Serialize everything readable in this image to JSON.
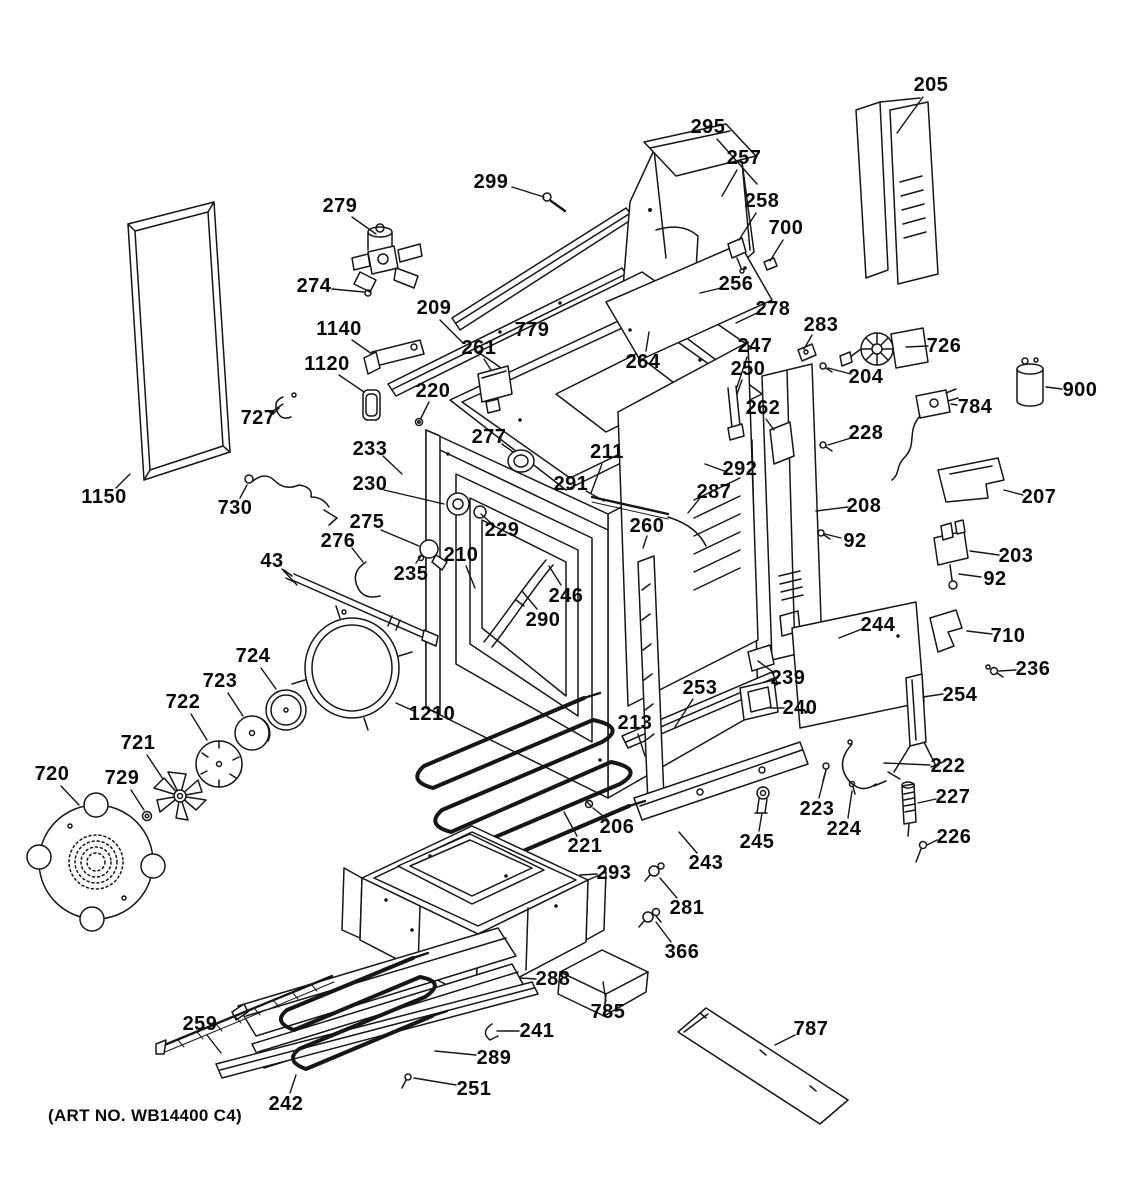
{
  "meta": {
    "art_no": "(ART NO. WB14400 C4)",
    "line_color": "#161616",
    "background_color": "#ffffff"
  },
  "callouts": [
    {
      "label": "205",
      "x": 931,
      "y": 85,
      "leader": [
        923,
        97,
        897,
        133
      ]
    },
    {
      "label": "295",
      "x": 708,
      "y": 127,
      "leader": [
        717,
        139,
        757,
        184
      ]
    },
    {
      "label": "257",
      "x": 744,
      "y": 158,
      "leader": [
        737,
        170,
        722,
        196
      ]
    },
    {
      "label": "299",
      "x": 491,
      "y": 182,
      "leader": [
        512,
        187,
        544,
        197
      ]
    },
    {
      "label": "258",
      "x": 762,
      "y": 201,
      "leader": [
        756,
        213,
        739,
        240
      ]
    },
    {
      "label": "700",
      "x": 786,
      "y": 228,
      "leader": [
        783,
        240,
        770,
        261
      ]
    },
    {
      "label": "279",
      "x": 340,
      "y": 206,
      "leader": [
        352,
        217,
        376,
        234
      ]
    },
    {
      "label": "274",
      "x": 314,
      "y": 286,
      "leader": [
        332,
        289,
        364,
        292
      ]
    },
    {
      "label": "256",
      "x": 736,
      "y": 284,
      "leader": [
        721,
        288,
        700,
        293
      ]
    },
    {
      "label": "278",
      "x": 773,
      "y": 309,
      "leader": [
        757,
        313,
        736,
        323
      ]
    },
    {
      "label": "283",
      "x": 821,
      "y": 325,
      "leader": [
        812,
        335,
        804,
        349
      ]
    },
    {
      "label": "726",
      "x": 944,
      "y": 346,
      "leader": [
        928,
        346,
        906,
        347
      ]
    },
    {
      "label": "209",
      "x": 434,
      "y": 308,
      "leader": [
        440,
        320,
        463,
        343
      ]
    },
    {
      "label": "1140",
      "x": 339,
      "y": 329,
      "leader": [
        352,
        340,
        372,
        354
      ]
    },
    {
      "label": "779",
      "x": 532,
      "y": 330,
      "leader": null
    },
    {
      "label": "261",
      "x": 479,
      "y": 348,
      "leader": [
        484,
        359,
        491,
        370
      ]
    },
    {
      "label": "1120",
      "x": 327,
      "y": 364,
      "leader": [
        339,
        375,
        364,
        392
      ]
    },
    {
      "label": "264",
      "x": 643,
      "y": 362,
      "leader": [
        646,
        351,
        649,
        332
      ]
    },
    {
      "label": "247",
      "x": 755,
      "y": 346,
      "leader": [
        747,
        357,
        737,
        387
      ]
    },
    {
      "label": "250",
      "x": 748,
      "y": 369,
      "leader": [
        742,
        380,
        737,
        394
      ]
    },
    {
      "label": "204",
      "x": 866,
      "y": 377,
      "leader": [
        851,
        374,
        828,
        368
      ]
    },
    {
      "label": "262",
      "x": 763,
      "y": 408,
      "leader": [
        766,
        419,
        774,
        430
      ]
    },
    {
      "label": "900",
      "x": 1080,
      "y": 390,
      "leader": [
        1062,
        389,
        1046,
        387
      ]
    },
    {
      "label": "784",
      "x": 975,
      "y": 407,
      "leader": [
        957,
        405,
        951,
        404
      ]
    },
    {
      "label": "220",
      "x": 433,
      "y": 391,
      "leader": [
        429,
        402,
        421,
        418
      ]
    },
    {
      "label": "727",
      "x": 258,
      "y": 418,
      "leader": [
        270,
        413,
        283,
        404
      ]
    },
    {
      "label": "277",
      "x": 489,
      "y": 437,
      "leader": [
        502,
        444,
        513,
        452
      ]
    },
    {
      "label": "211",
      "x": 607,
      "y": 452,
      "leader": [
        602,
        464,
        591,
        493
      ]
    },
    {
      "label": "291",
      "x": 571,
      "y": 484,
      "leader": [
        586,
        491,
        604,
        501
      ]
    },
    {
      "label": "292",
      "x": 740,
      "y": 469,
      "leader": [
        727,
        472,
        705,
        464
      ]
    },
    {
      "label": "287",
      "x": 714,
      "y": 492,
      "leader": [
        700,
        498,
        688,
        513
      ]
    },
    {
      "label": "228",
      "x": 866,
      "y": 433,
      "leader": [
        851,
        438,
        828,
        445
      ]
    },
    {
      "label": "233",
      "x": 370,
      "y": 449,
      "leader": [
        383,
        456,
        402,
        474
      ]
    },
    {
      "label": "230",
      "x": 370,
      "y": 484,
      "leader": [
        384,
        490,
        444,
        504
      ]
    },
    {
      "label": "229",
      "x": 502,
      "y": 530,
      "leader": [
        491,
        523,
        481,
        514
      ]
    },
    {
      "label": "260",
      "x": 647,
      "y": 526,
      "leader": [
        647,
        536,
        643,
        548
      ]
    },
    {
      "label": "208",
      "x": 864,
      "y": 506,
      "leader": [
        848,
        507,
        816,
        511
      ]
    },
    {
      "label": "92",
      "x": 855,
      "y": 541,
      "leader": [
        841,
        538,
        825,
        534
      ]
    },
    {
      "label": "207",
      "x": 1039,
      "y": 497,
      "leader": [
        1023,
        495,
        1004,
        490
      ]
    },
    {
      "label": "203",
      "x": 1016,
      "y": 556,
      "leader": [
        999,
        555,
        970,
        551
      ]
    },
    {
      "label": "92",
      "x": 995,
      "y": 579,
      "leader": [
        981,
        577,
        959,
        574
      ]
    },
    {
      "label": "275",
      "x": 367,
      "y": 522,
      "leader": [
        381,
        530,
        419,
        546
      ]
    },
    {
      "label": "276",
      "x": 338,
      "y": 541,
      "leader": [
        352,
        548,
        363,
        562
      ]
    },
    {
      "label": "43",
      "x": 272,
      "y": 561,
      "leader": [
        282,
        569,
        297,
        585
      ]
    },
    {
      "label": "730",
      "x": 235,
      "y": 508,
      "leader": [
        240,
        498,
        247,
        485
      ]
    },
    {
      "label": "1150",
      "x": 104,
      "y": 497,
      "leader": [
        116,
        488,
        130,
        474
      ]
    },
    {
      "label": "235",
      "x": 411,
      "y": 574,
      "leader": [
        416,
        563,
        421,
        556
      ]
    },
    {
      "label": "210",
      "x": 461,
      "y": 555,
      "leader": [
        466,
        566,
        475,
        588
      ]
    },
    {
      "label": "246",
      "x": 566,
      "y": 596,
      "leader": [
        561,
        585,
        549,
        566
      ]
    },
    {
      "label": "290",
      "x": 543,
      "y": 620,
      "leader": [
        537,
        609,
        522,
        591
      ]
    },
    {
      "label": "244",
      "x": 878,
      "y": 625,
      "leader": [
        862,
        629,
        839,
        638
      ]
    },
    {
      "label": "710",
      "x": 1008,
      "y": 636,
      "leader": [
        992,
        634,
        967,
        631
      ]
    },
    {
      "label": "236",
      "x": 1033,
      "y": 669,
      "leader": [
        1016,
        670,
        999,
        671
      ]
    },
    {
      "label": "254",
      "x": 960,
      "y": 695,
      "leader": [
        943,
        694,
        923,
        697
      ]
    },
    {
      "label": "724",
      "x": 253,
      "y": 656,
      "leader": [
        261,
        668,
        276,
        689
      ]
    },
    {
      "label": "723",
      "x": 220,
      "y": 681,
      "leader": [
        228,
        693,
        243,
        716
      ]
    },
    {
      "label": "722",
      "x": 183,
      "y": 702,
      "leader": [
        191,
        714,
        207,
        740
      ]
    },
    {
      "label": "721",
      "x": 138,
      "y": 743,
      "leader": [
        147,
        755,
        163,
        779
      ]
    },
    {
      "label": "729",
      "x": 122,
      "y": 778,
      "leader": [
        131,
        790,
        144,
        810
      ]
    },
    {
      "label": "720",
      "x": 52,
      "y": 774,
      "leader": [
        61,
        786,
        79,
        805
      ]
    },
    {
      "label": "1210",
      "x": 432,
      "y": 714,
      "leader": [
        414,
        711,
        396,
        703
      ]
    },
    {
      "label": "253",
      "x": 700,
      "y": 688,
      "leader": [
        693,
        699,
        675,
        727
      ]
    },
    {
      "label": "239",
      "x": 788,
      "y": 678,
      "leader": [
        773,
        672,
        758,
        661
      ]
    },
    {
      "label": "240",
      "x": 800,
      "y": 708,
      "leader": [
        784,
        708,
        770,
        708
      ]
    },
    {
      "label": "213",
      "x": 635,
      "y": 723,
      "leader": [
        638,
        734,
        645,
        756
      ]
    },
    {
      "label": "222",
      "x": 948,
      "y": 766,
      "leader": [
        930,
        765,
        884,
        763
      ]
    },
    {
      "label": "227",
      "x": 953,
      "y": 797,
      "leader": [
        936,
        799,
        918,
        803
      ]
    },
    {
      "label": "223",
      "x": 817,
      "y": 809,
      "leader": [
        819,
        798,
        825,
        774
      ]
    },
    {
      "label": "224",
      "x": 844,
      "y": 829,
      "leader": [
        848,
        818,
        852,
        791
      ]
    },
    {
      "label": "226",
      "x": 954,
      "y": 837,
      "leader": [
        937,
        840,
        927,
        845
      ]
    },
    {
      "label": "245",
      "x": 757,
      "y": 842,
      "leader": [
        759,
        831,
        762,
        813
      ]
    },
    {
      "label": "243",
      "x": 706,
      "y": 863,
      "leader": [
        697,
        853,
        679,
        832
      ]
    },
    {
      "label": "206",
      "x": 617,
      "y": 827,
      "leader": [
        607,
        819,
        593,
        808
      ]
    },
    {
      "label": "221",
      "x": 585,
      "y": 846,
      "leader": [
        577,
        836,
        564,
        812
      ]
    },
    {
      "label": "293",
      "x": 614,
      "y": 873,
      "leader": [
        597,
        874,
        580,
        875
      ]
    },
    {
      "label": "281",
      "x": 687,
      "y": 908,
      "leader": [
        677,
        898,
        660,
        878
      ]
    },
    {
      "label": "366",
      "x": 682,
      "y": 952,
      "leader": [
        671,
        942,
        656,
        922
      ]
    },
    {
      "label": "288",
      "x": 553,
      "y": 979,
      "leader": [
        536,
        979,
        520,
        978
      ]
    },
    {
      "label": "785",
      "x": 608,
      "y": 1012,
      "leader": [
        606,
        1001,
        603,
        982
      ]
    },
    {
      "label": "241",
      "x": 537,
      "y": 1031,
      "leader": [
        519,
        1031,
        497,
        1031
      ]
    },
    {
      "label": "289",
      "x": 494,
      "y": 1058,
      "leader": [
        476,
        1055,
        435,
        1051
      ]
    },
    {
      "label": "251",
      "x": 474,
      "y": 1089,
      "leader": [
        456,
        1085,
        414,
        1078
      ]
    },
    {
      "label": "242",
      "x": 286,
      "y": 1104,
      "leader": [
        290,
        1093,
        296,
        1075
      ]
    },
    {
      "label": "259",
      "x": 200,
      "y": 1024,
      "leader": [
        207,
        1035,
        221,
        1053
      ]
    },
    {
      "label": "787",
      "x": 811,
      "y": 1029,
      "leader": [
        795,
        1035,
        775,
        1045
      ]
    }
  ]
}
